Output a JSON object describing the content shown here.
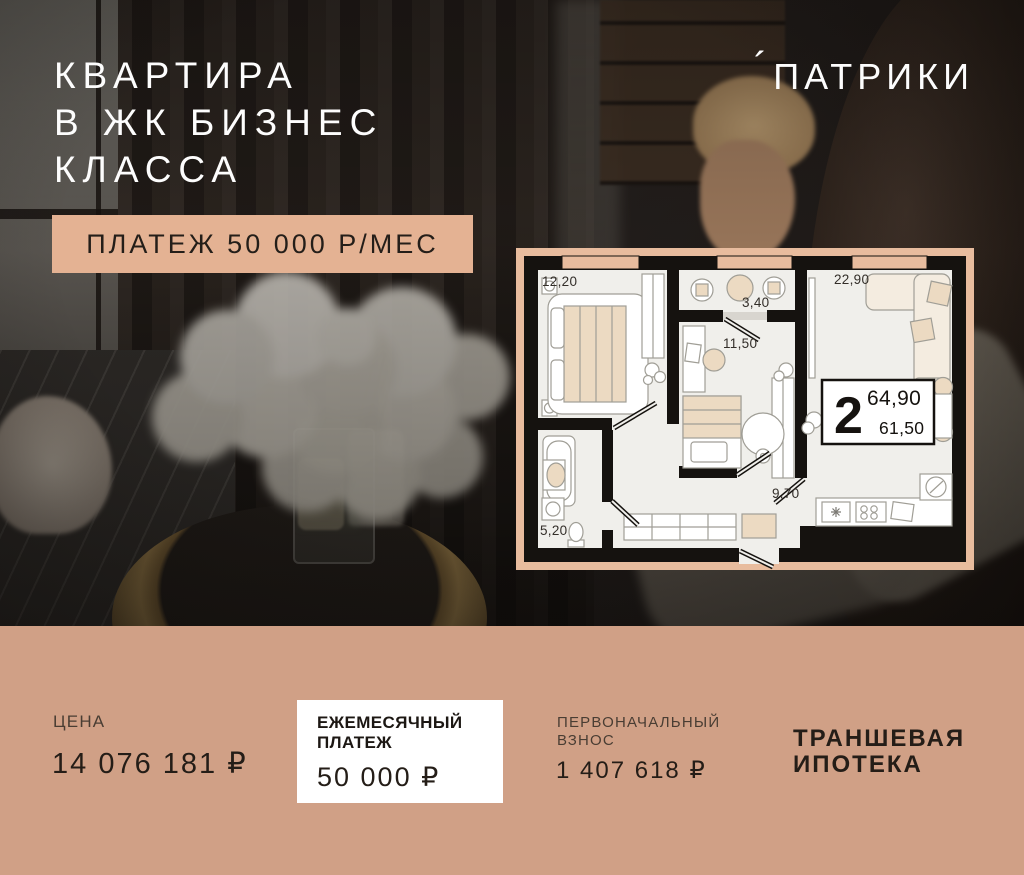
{
  "colors": {
    "accent_peach": "#e4b293",
    "plan_frame": "#e8bc9e",
    "bottom_band": "#d0a086",
    "card_bg": "#ffffff",
    "ink": "#241d17",
    "headline": "#fdfdfd"
  },
  "header": {
    "headline_lines": [
      "КВАРТИРА",
      "В ЖК БИЗНЕС",
      "КЛАССА"
    ],
    "logo_accent": "´",
    "logo": "ПАТРИКИ"
  },
  "badge": {
    "label": "ПЛАТЕЖ 50 000 Р/МЕС"
  },
  "floorplan": {
    "rooms": [
      {
        "id": "bedroom",
        "area": "12,20"
      },
      {
        "id": "loggia",
        "area": "3,40"
      },
      {
        "id": "living-kitchen",
        "area": "22,90"
      },
      {
        "id": "room-2",
        "area": "11,50"
      },
      {
        "id": "hallway",
        "area": "9,70"
      },
      {
        "id": "bathroom",
        "area": "5,20"
      }
    ],
    "info_box": {
      "rooms_count": "2",
      "area_total": "64,90",
      "area_living": "61,50"
    }
  },
  "pricing": {
    "price": {
      "label": "ЦЕНА",
      "value": "14 076 181 ₽"
    },
    "monthly": {
      "label_line1": "ЕЖЕМЕСЯЧНЫЙ",
      "label_line2": "ПЛАТЕЖ",
      "value": "50 000 ₽"
    },
    "down_payment": {
      "label_line1": "ПЕРВОНАЧАЛЬНЫЙ",
      "label_line2": "ВЗНОС",
      "value": "1 407 618 ₽"
    },
    "mortgage": {
      "line1": "ТРАНШЕВАЯ",
      "line2": "ИПОТЕКА"
    }
  }
}
